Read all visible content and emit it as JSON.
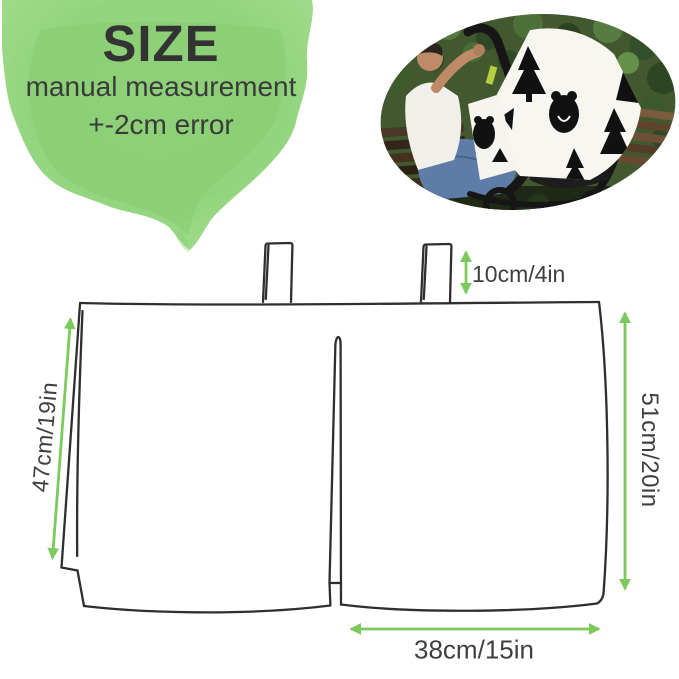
{
  "header": {
    "title": "SIZE",
    "note_line1": "manual measurement",
    "note_line2": "+-2cm error"
  },
  "photo": {
    "alt": "mother on park bench beside stroller covered with black-and-white bear and pine-tree patterned canopy"
  },
  "diagram": {
    "subject": "canopy cover line drawing with two hanging tabs",
    "measurements": {
      "tab_height": "10cm/4in",
      "left_height": "47cm/19in",
      "right_height": "51cm/20in",
      "bottom_width": "38cm/15in"
    }
  },
  "colors": {
    "accent_green": "#7cc95d",
    "blob_green": "#8fd37a",
    "line_dark": "#2f2f2f",
    "text_dark": "#3a3a3a"
  }
}
